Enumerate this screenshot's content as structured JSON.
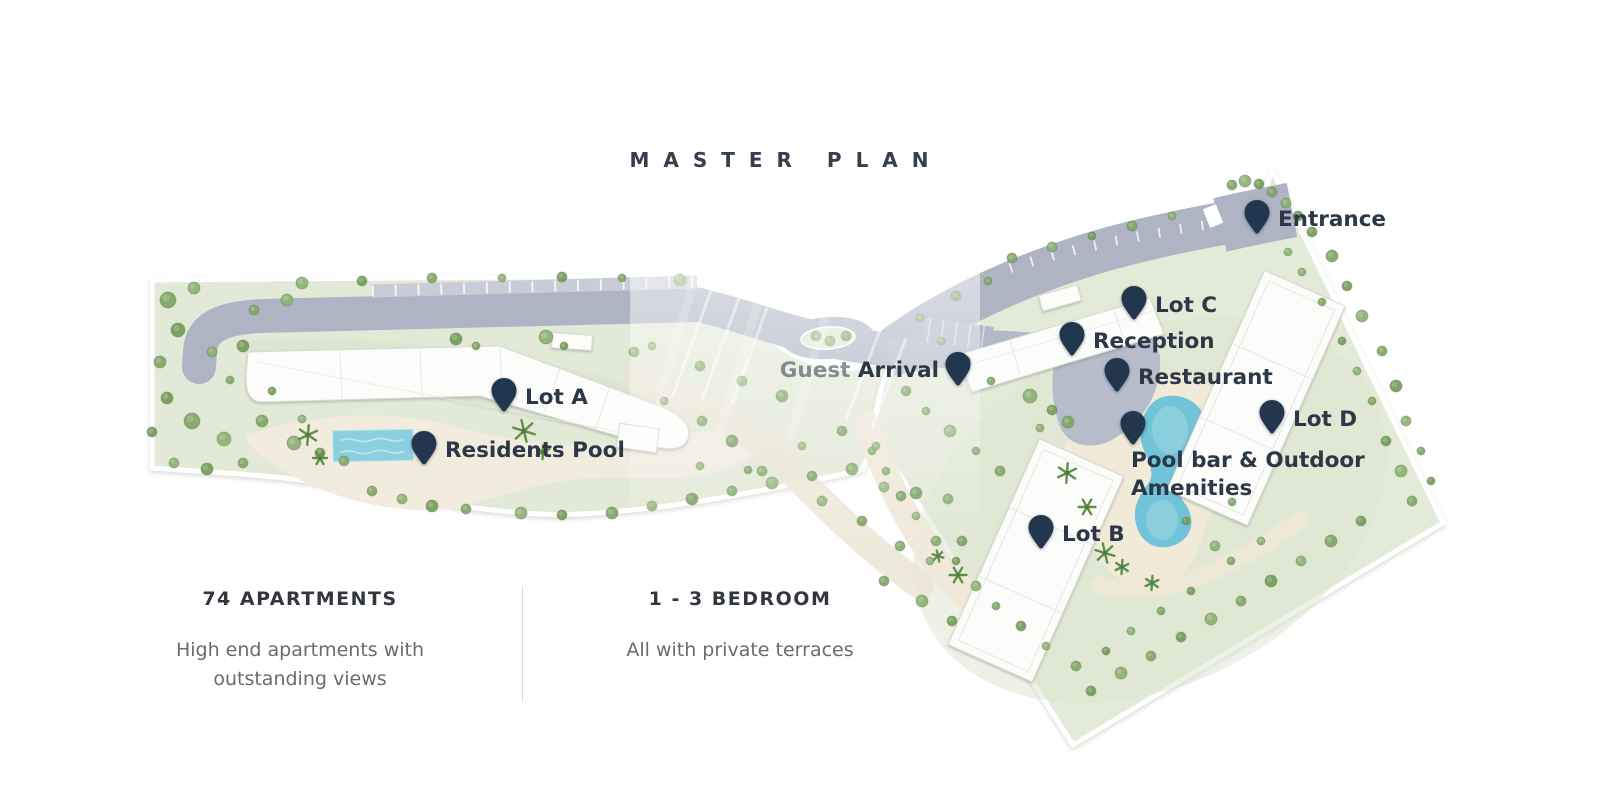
{
  "title": "MASTER PLAN",
  "map": {
    "pin_color": "#22374e",
    "label_color": "#2c3747",
    "markers": [
      {
        "id": "entrance",
        "label": "Entrance",
        "x": 1257,
        "y": 212,
        "side": "right"
      },
      {
        "id": "lot-c",
        "label": "Lot C",
        "x": 1134,
        "y": 298,
        "side": "right"
      },
      {
        "id": "reception",
        "label": "Reception",
        "x": 1072,
        "y": 334,
        "side": "right"
      },
      {
        "id": "restaurant",
        "label": "Restaurant",
        "x": 1117,
        "y": 370,
        "side": "right"
      },
      {
        "id": "guest-arrival",
        "label": "Guest Arrival",
        "x": 958,
        "y": 364,
        "side": "left",
        "faded_first_word": true
      },
      {
        "id": "lot-a",
        "label": "Lot A",
        "x": 504,
        "y": 390,
        "side": "right"
      },
      {
        "id": "residents-pool",
        "label": "Residents Pool",
        "x": 424,
        "y": 443,
        "side": "right"
      },
      {
        "id": "lot-d",
        "label": "Lot D",
        "x": 1272,
        "y": 412,
        "side": "right"
      },
      {
        "id": "pool-bar-outdoor-amenities",
        "label": "Pool bar & Outdoor Amenities",
        "x": 1133,
        "y": 423,
        "side": "below"
      },
      {
        "id": "lot-b",
        "label": "Lot B",
        "x": 1041,
        "y": 527,
        "side": "right"
      }
    ]
  },
  "stats": {
    "items": [
      {
        "heading": "74 APARTMENTS",
        "description": "High end apartments with outstanding views"
      },
      {
        "heading": "1 - 3 BEDROOM",
        "description": "All with private terraces"
      }
    ]
  }
}
